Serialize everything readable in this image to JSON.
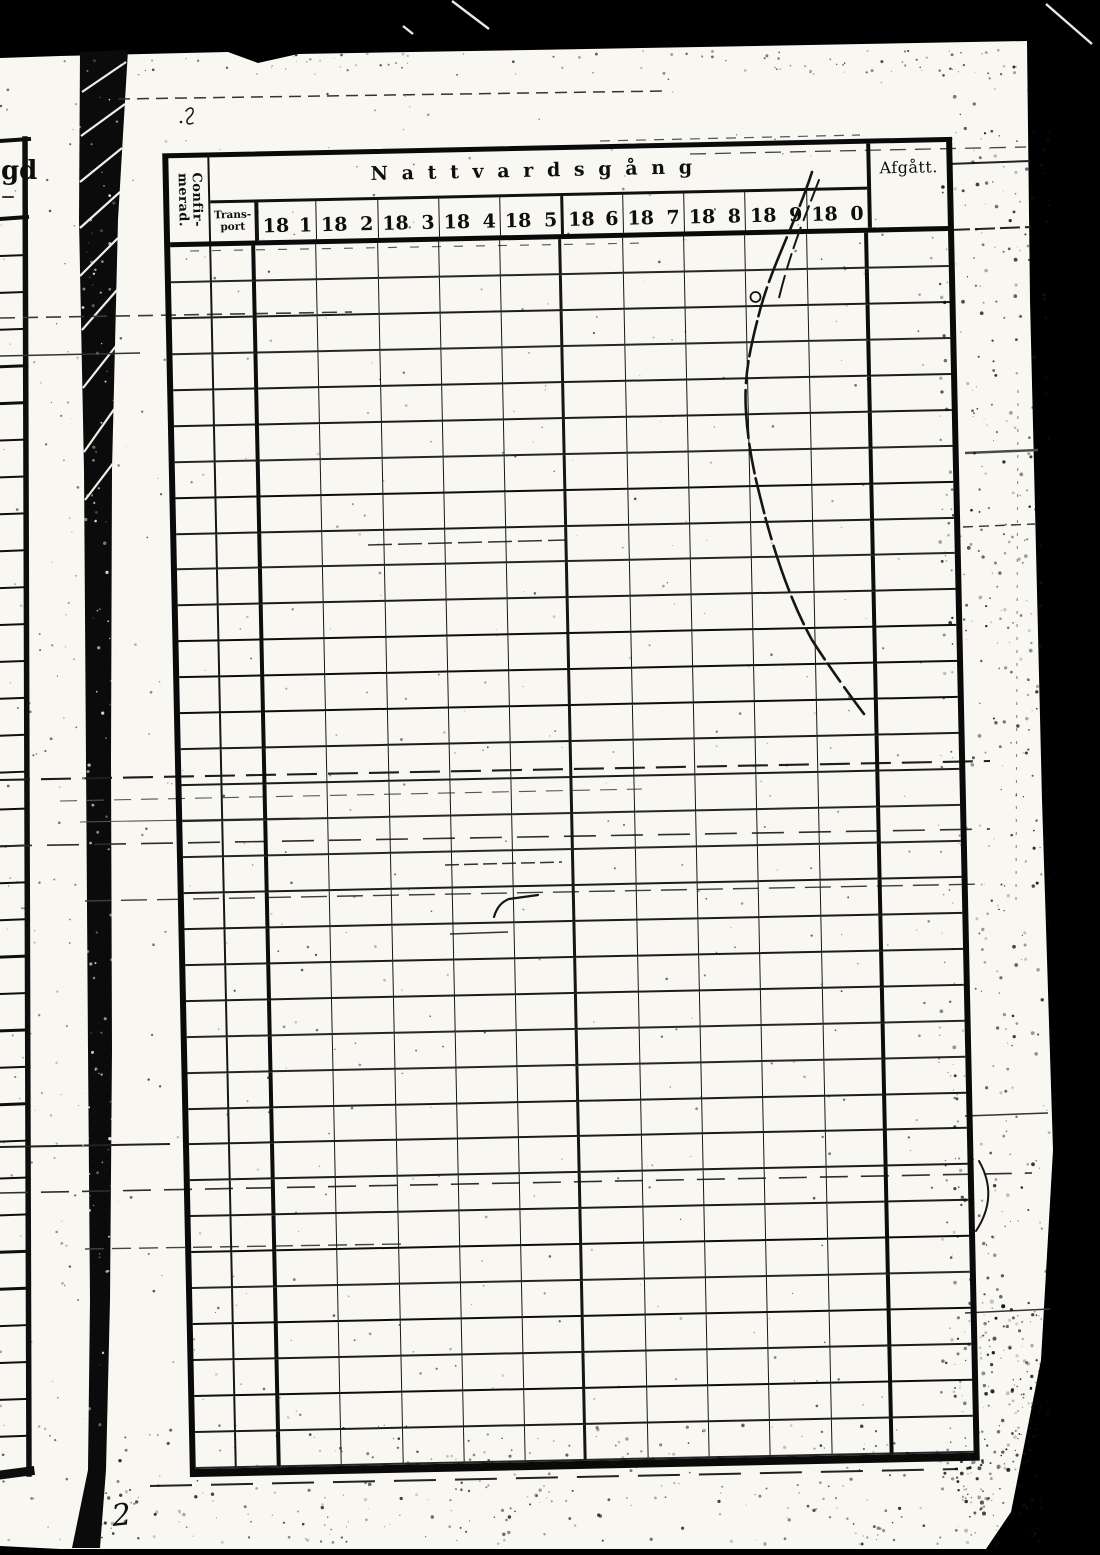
{
  "scan": {
    "communion_table": {
      "title": "Nattvardsgång",
      "confirmed": {
        "line1": "Confir-",
        "line2": "merad."
      },
      "transport": {
        "line1": "Trans-",
        "line2": "port"
      },
      "year_prefix": "18",
      "year_digits": [
        "1",
        "2",
        "3",
        "4",
        "5",
        "6",
        "7",
        "8",
        "9",
        "0"
      ],
      "departed": "Afgått."
    },
    "left_page_fragment": {
      "partial_label": "gd"
    },
    "handwritten": {
      "page_number": "2"
    }
  }
}
